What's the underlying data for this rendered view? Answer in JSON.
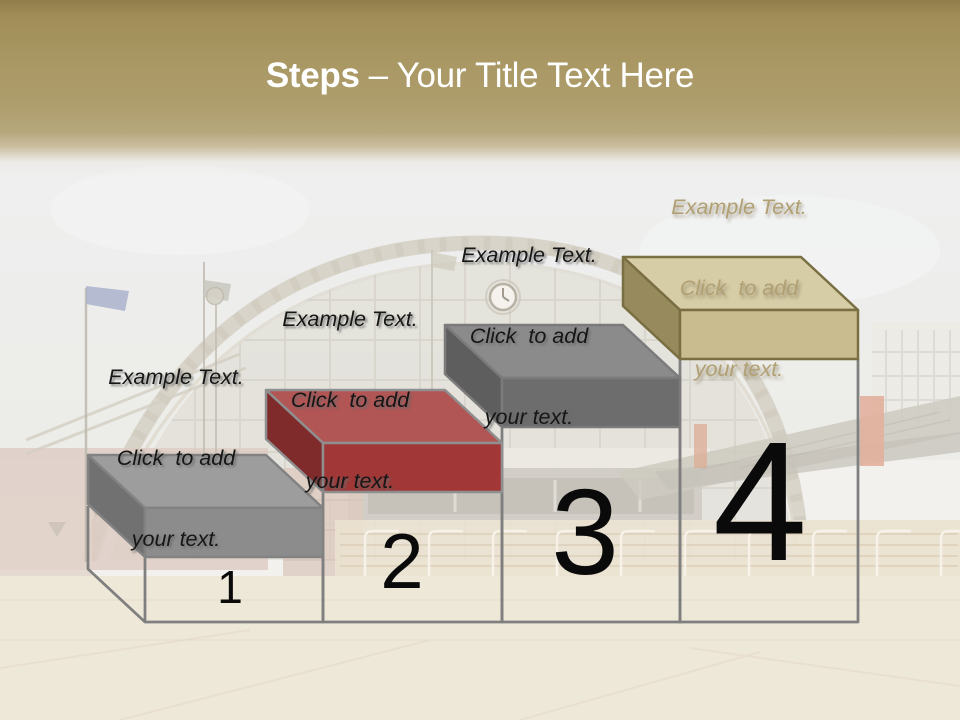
{
  "title": {
    "bold": "Steps",
    "rest": "– Your Title Text Here",
    "text_color": "#ffffff",
    "band_gold": "#aa9965"
  },
  "number_color": "#0a0a0a",
  "steps": [
    {
      "number": "1",
      "label_lines": [
        "Example Text.",
        "Click  to add",
        "your text."
      ],
      "colors": {
        "top": "#9d9d9d",
        "front": "#8c8c8c",
        "side": "#717171",
        "outline": "#828282",
        "wire": "#7f7f7f"
      }
    },
    {
      "number": "2",
      "label_lines": [
        "Example Text.",
        "Click  to add",
        "your text."
      ],
      "colors": {
        "top": "#b25555",
        "front": "#a13737",
        "side": "#7f2b2b",
        "outline": "#8f8f8f",
        "wire": "#7f7f7f"
      }
    },
    {
      "number": "3",
      "label_lines": [
        "Example Text.",
        "Click  to add",
        "your text."
      ],
      "colors": {
        "top": "#8b8b8b",
        "front": "#6d6d6d",
        "side": "#5e5e5e",
        "outline": "#7b7b7b",
        "wire": "#7f7f7f"
      }
    },
    {
      "number": "4",
      "label_lines": [
        "Example Text.",
        "Click  to add",
        "your text."
      ],
      "colors": {
        "top": "#d6cca6",
        "front": "#c9bd90",
        "side": "#978a5d",
        "outline": "#7a6f42",
        "wire": "#7f7f7f"
      }
    }
  ]
}
